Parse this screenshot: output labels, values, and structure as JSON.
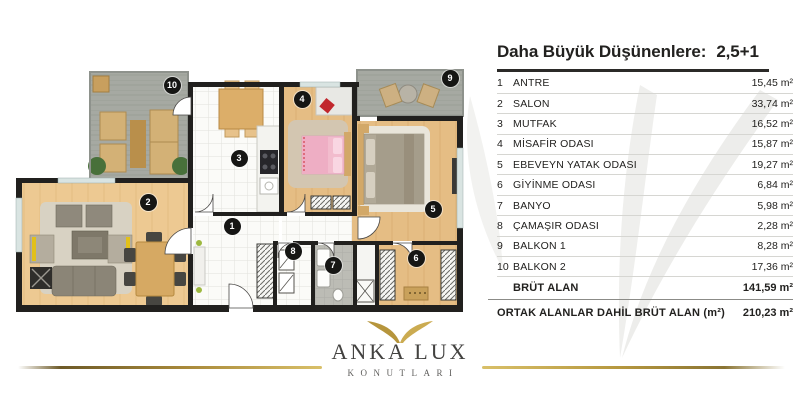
{
  "header": {
    "title_left": "Daha Büyük Düşünenlere:",
    "title_right": "2,5+1"
  },
  "table": {
    "rooms": [
      {
        "num": "1",
        "label": "ANTRE",
        "value": "15,45 m²"
      },
      {
        "num": "2",
        "label": "SALON",
        "value": "33,74 m²"
      },
      {
        "num": "3",
        "label": "MUTFAK",
        "value": "16,52 m²"
      },
      {
        "num": "4",
        "label": "MİSAFİR ODASI",
        "value": "15,87 m²"
      },
      {
        "num": "5",
        "label": "EBEVEYN YATAK ODASI",
        "value": "19,27 m²"
      },
      {
        "num": "6",
        "label": "GİYİNME ODASI",
        "value": "6,84 m²"
      },
      {
        "num": "7",
        "label": "BANYO",
        "value": "5,98 m²"
      },
      {
        "num": "8",
        "label": "ÇAMAŞIR ODASI",
        "value": "2,28 m²"
      },
      {
        "num": "9",
        "label": "BALKON 1",
        "value": "8,28 m²"
      },
      {
        "num": "10",
        "label": "BALKON 2",
        "value": "17,36 m²"
      }
    ],
    "totals": [
      {
        "label": "BRÜT ALAN",
        "value": "141,59 m²"
      },
      {
        "label": "ORTAK ALANLAR DAHİL BRÜT ALAN (m²)",
        "value": "210,23 m²"
      }
    ]
  },
  "plan": {
    "badges": [
      {
        "n": "1",
        "room": "antre",
        "x": 232,
        "y": 226
      },
      {
        "n": "2",
        "room": "salon",
        "x": 148,
        "y": 202
      },
      {
        "n": "3",
        "room": "mutfak",
        "x": 239,
        "y": 158
      },
      {
        "n": "4",
        "room": "misafir-odasi",
        "x": 302,
        "y": 99
      },
      {
        "n": "5",
        "room": "ebeveyn-yatak-odasi",
        "x": 433,
        "y": 209
      },
      {
        "n": "6",
        "room": "giyinme-odasi",
        "x": 416,
        "y": 258
      },
      {
        "n": "7",
        "room": "banyo",
        "x": 333,
        "y": 265
      },
      {
        "n": "8",
        "room": "camasir-odasi",
        "x": 293,
        "y": 251
      },
      {
        "n": "9",
        "room": "balkon-1",
        "x": 450,
        "y": 78
      },
      {
        "n": "10",
        "room": "balkon-2",
        "x": 172,
        "y": 85
      }
    ],
    "colors": {
      "wood": "#edc992",
      "wood_dark": "#e5bd84",
      "balcony": "#a6a9a2",
      "wall": "#21201e",
      "gold": "#c4a24c",
      "badge": "#161614",
      "accent_yellow": "#e2c019",
      "bed_pink": "#f2bccd",
      "accent_red": "#c1272d"
    }
  },
  "logo": {
    "name": "ANKA LUX",
    "subtitle": "KONUTLARI"
  }
}
